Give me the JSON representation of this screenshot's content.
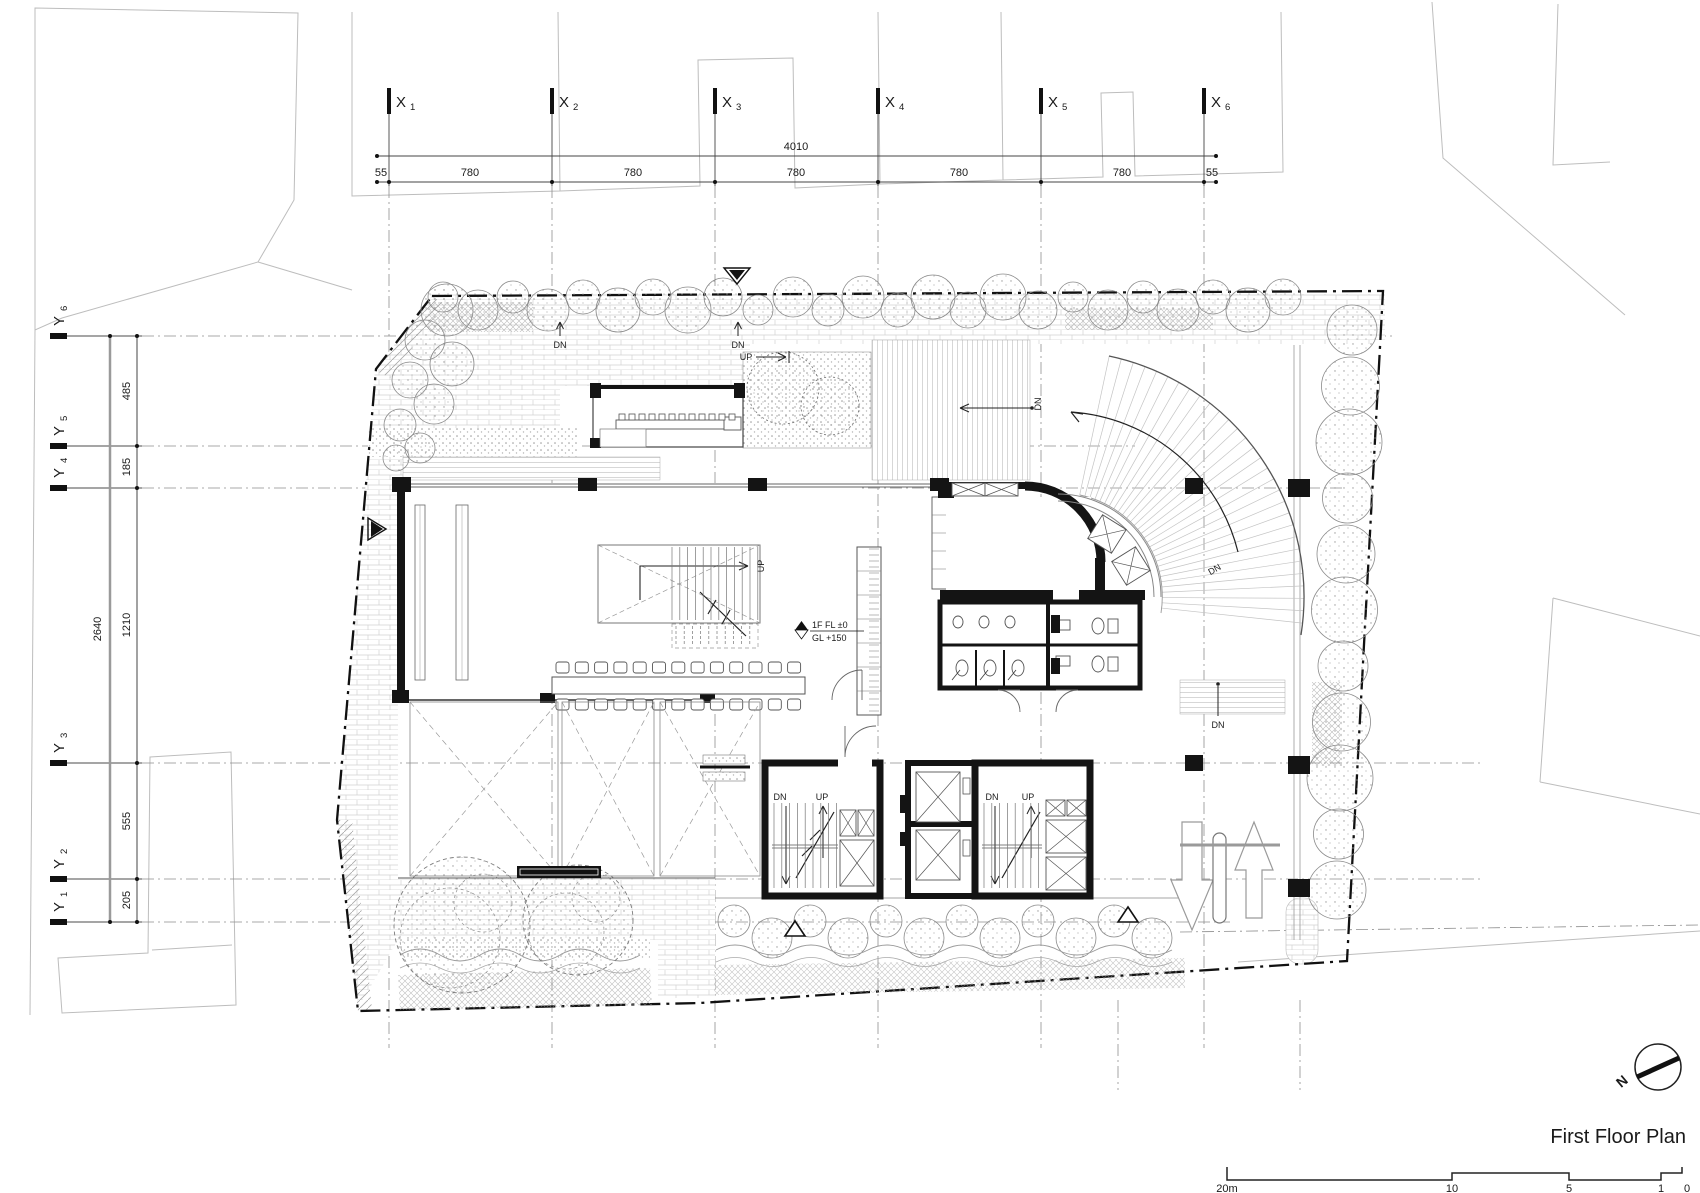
{
  "title": "First Floor Plan",
  "north_label": "N",
  "axes": {
    "x": [
      {
        "letter": "X",
        "num": "1"
      },
      {
        "letter": "X",
        "num": "2"
      },
      {
        "letter": "X",
        "num": "3"
      },
      {
        "letter": "X",
        "num": "4"
      },
      {
        "letter": "X",
        "num": "5"
      },
      {
        "letter": "X",
        "num": "6"
      }
    ],
    "y": [
      {
        "letter": "Y",
        "num": "1"
      },
      {
        "letter": "Y",
        "num": "2"
      },
      {
        "letter": "Y",
        "num": "3"
      },
      {
        "letter": "Y",
        "num": "4"
      },
      {
        "letter": "Y",
        "num": "5"
      },
      {
        "letter": "Y",
        "num": "6"
      }
    ]
  },
  "dimensions": {
    "top": {
      "total": "4010",
      "segments": [
        "55",
        "780",
        "780",
        "780",
        "780",
        "780",
        "55"
      ]
    },
    "left": {
      "total": "2640",
      "segments": [
        "485",
        "185",
        "1210",
        "555",
        "205"
      ]
    }
  },
  "stair_labels": {
    "dn": "DN",
    "up": "UP"
  },
  "level_marker": {
    "line1": "1F FL ±0",
    "line2": "GL +150"
  },
  "scale_bar": {
    "ticks": [
      "20m",
      "10",
      "5",
      "1",
      "0"
    ]
  },
  "colors": {
    "wall": "#141414",
    "grid": "#8e8e8e",
    "context": "#bdbdbd",
    "boundary": "#111111"
  }
}
